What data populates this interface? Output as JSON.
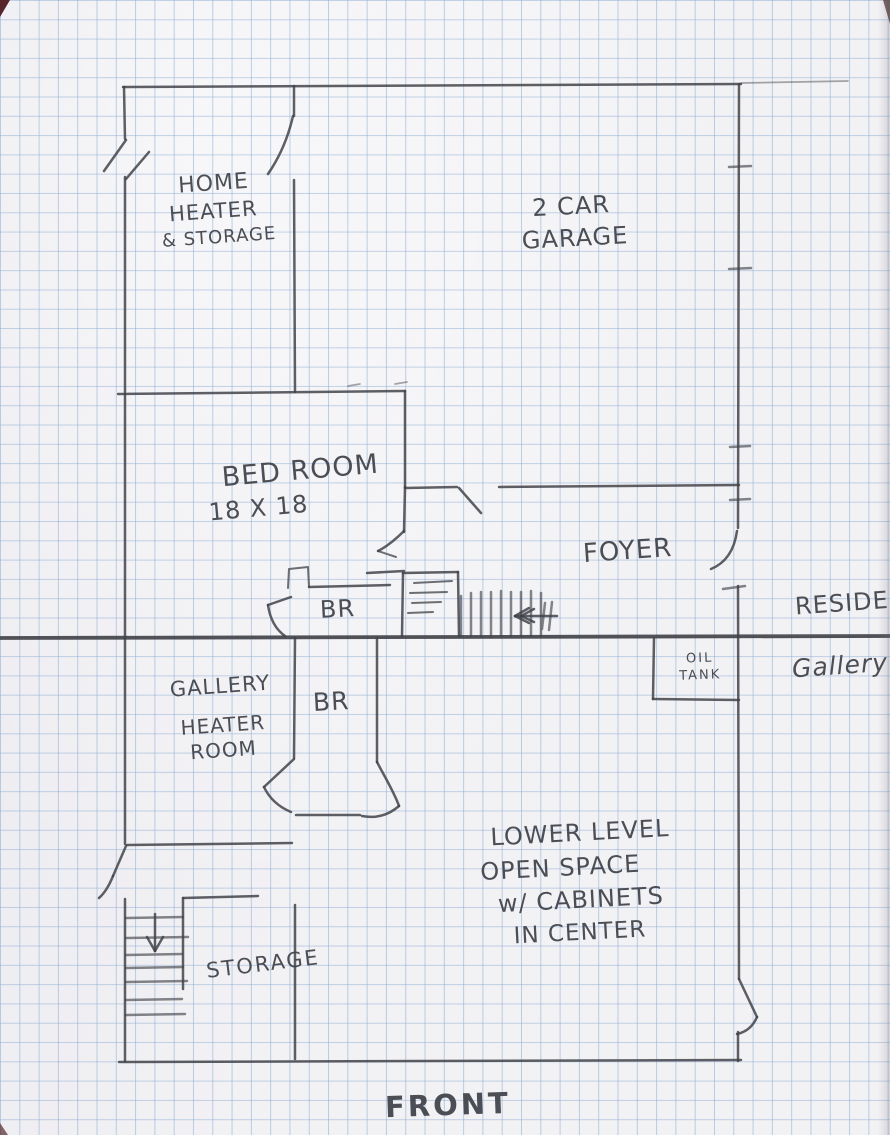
{
  "document": {
    "title": "Hand-drawn floor plan sketch",
    "medium": "pencil on blue graph paper"
  },
  "rooms": {
    "home_heater": {
      "line1": "HOME",
      "line2": "HEATER",
      "line3": "& STORAGE"
    },
    "garage": {
      "line1": "2 CAR",
      "line2": "GARAGE"
    },
    "bedroom": {
      "line1": "BED ROOM",
      "line2": "18 X 18"
    },
    "foyer": {
      "label": "FOYER"
    },
    "bath_upper": {
      "label": "BR"
    },
    "bath_lower": {
      "label": "BR"
    },
    "gallery_heater": {
      "line1": "GALLERY",
      "line2": "HEATER",
      "line3": "ROOM"
    },
    "oil_tank": {
      "line1": "OIL",
      "line2": "TANK"
    },
    "lower_level": {
      "line1": "LOWER LEVEL",
      "line2": "OPEN SPACE",
      "line3": "w/ CABINETS",
      "line4": "IN CENTER"
    },
    "storage": {
      "label": "STORAGE"
    }
  },
  "annotations": {
    "resident": "RESIDENT",
    "gallery_side": "Gallery",
    "front": "FRONT"
  },
  "symbols": {
    "upper_stairs_arrow": "arrow-left",
    "lower_stairs_arrow": "arrow-down"
  },
  "colors": {
    "paper": "#f2f1f4",
    "grid_line": "#bdd2e8",
    "pencil": "#43454c"
  }
}
